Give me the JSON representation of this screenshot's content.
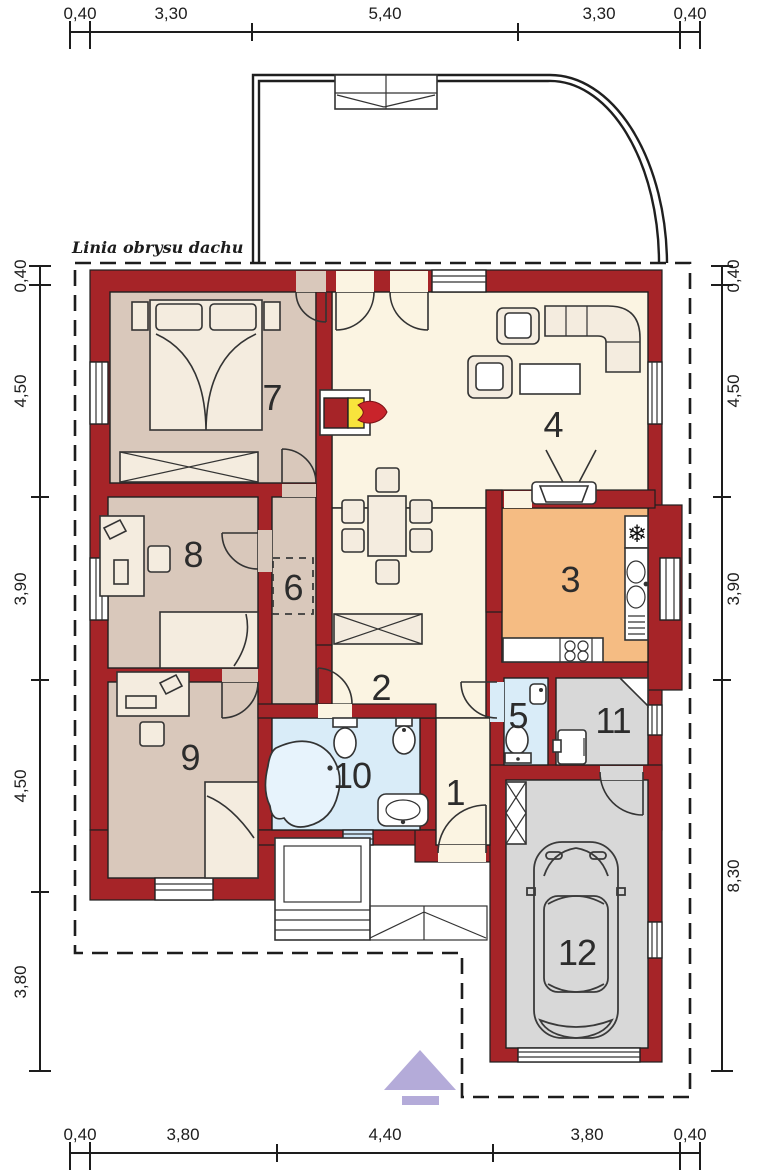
{
  "labels": {
    "roof_outline": "Linia obrysu dachu"
  },
  "dimensions": {
    "top": [
      "0,40",
      "3,30",
      "5,40",
      "3,30",
      "0,40"
    ],
    "bottom": [
      "0,40",
      "3,80",
      "4,40",
      "3,80",
      "0,40"
    ],
    "left": [
      "0,40",
      "4,50",
      "3,90",
      "4,50",
      "3,80"
    ],
    "right": [
      "0,40",
      "4,50",
      "3,90",
      "8,30"
    ]
  },
  "rooms": {
    "r1": "1",
    "r2": "2",
    "r3": "3",
    "r4": "4",
    "r5": "5",
    "r6": "6",
    "r7": "7",
    "r8": "8",
    "r9": "9",
    "r10": "10",
    "r11": "11",
    "r12": "12"
  },
  "icons": {
    "snowflake": "❄"
  },
  "colors": {
    "wall_red": "#a62428",
    "bedroom_floor_tan": "#d9c8bb",
    "hall_floor_cream": "#fbf4e2",
    "kitchen_floor_orange": "#f5bc83",
    "bath_floor_blue": "#d9ecf8",
    "garage_floor_gray": "#d8d8d8",
    "fireplace_yellow": "#f8e43c",
    "entrance_arrow_purple": "#b4abd9"
  }
}
